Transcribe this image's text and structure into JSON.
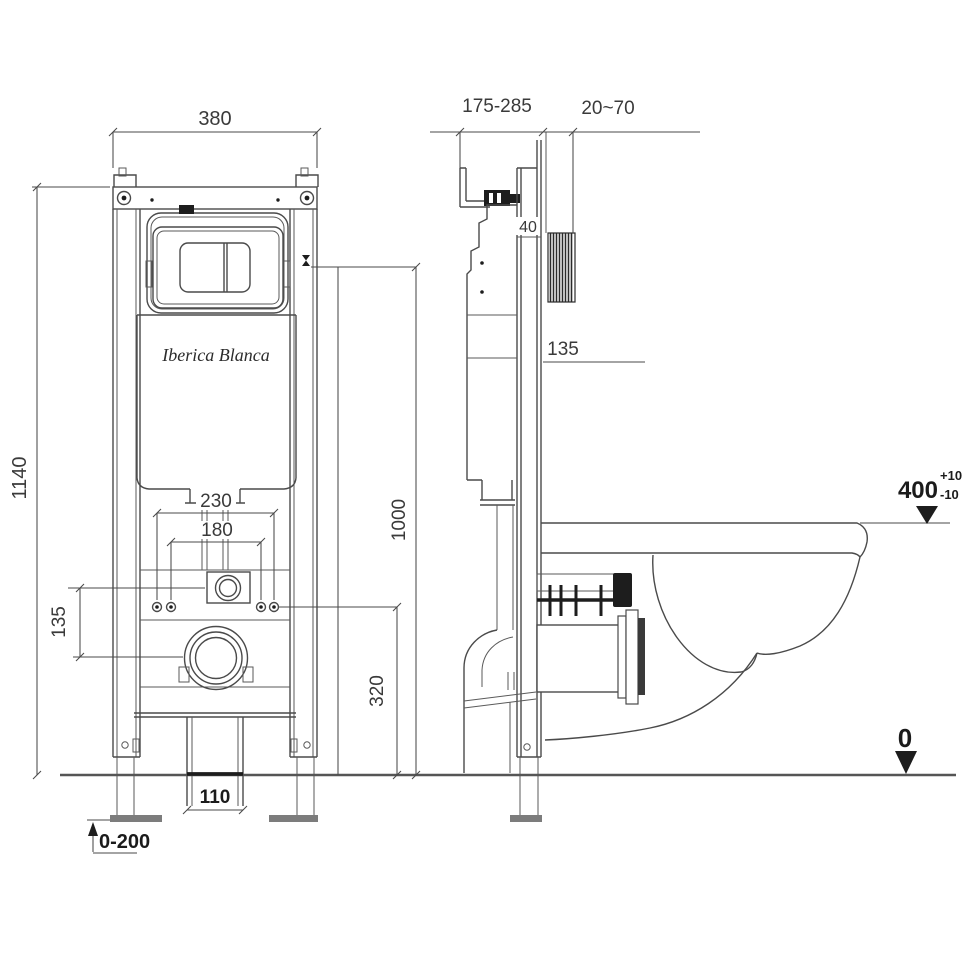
{
  "brand": "Iberica Blanca",
  "front": {
    "width": "380",
    "height": "1140",
    "bolt_spacing_outer": "230",
    "bolt_spacing_inner": "180",
    "inlet_drain_offset": "135",
    "drain_center_height": "320",
    "actuation_height": "1000",
    "outlet_pipe_width": "110",
    "feet_adjust_range": "0-200"
  },
  "side": {
    "install_depth_range": "175-285",
    "wall_finish_range": "20~70",
    "frame_depth": "40",
    "supply_offset": "135",
    "rim_height": "400",
    "rim_tol_plus": "+10",
    "rim_tol_minus": "-10",
    "floor_level": "0"
  },
  "colors": {
    "ink": "#4a4a4a",
    "text": "#3a3a3a",
    "accent_dark": "#1d1d1d"
  }
}
